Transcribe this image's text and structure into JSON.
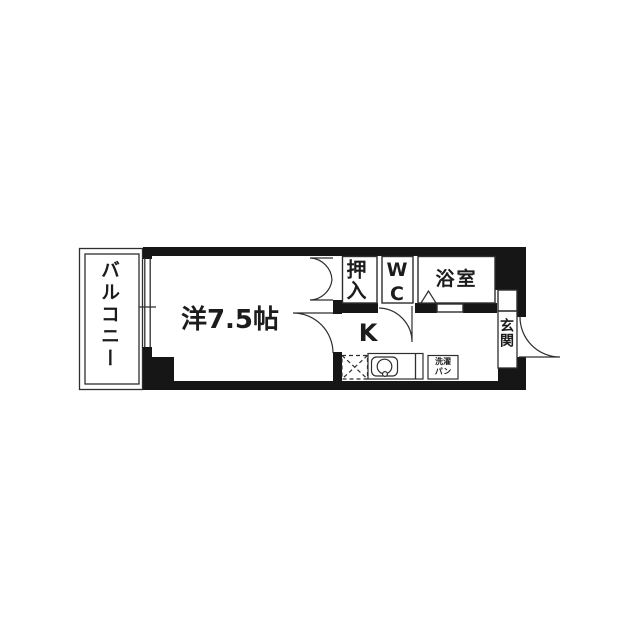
{
  "plan": {
    "rooms": {
      "balcony": {
        "label": "バルコニー"
      },
      "main_room": {
        "label": "洋7.5帖"
      },
      "closet": {
        "label": "押入"
      },
      "toilet": {
        "label": "WC"
      },
      "bath": {
        "label": "浴室"
      },
      "kitchen": {
        "label": "K"
      },
      "entrance": {
        "label": "玄関"
      },
      "washer_pan": {
        "line1": "洗濯",
        "line2": "パン"
      }
    },
    "colors": {
      "wall": "#161616",
      "line": "#2e2e2e",
      "text": "#1c1c1c",
      "background": "#ffffff"
    }
  }
}
